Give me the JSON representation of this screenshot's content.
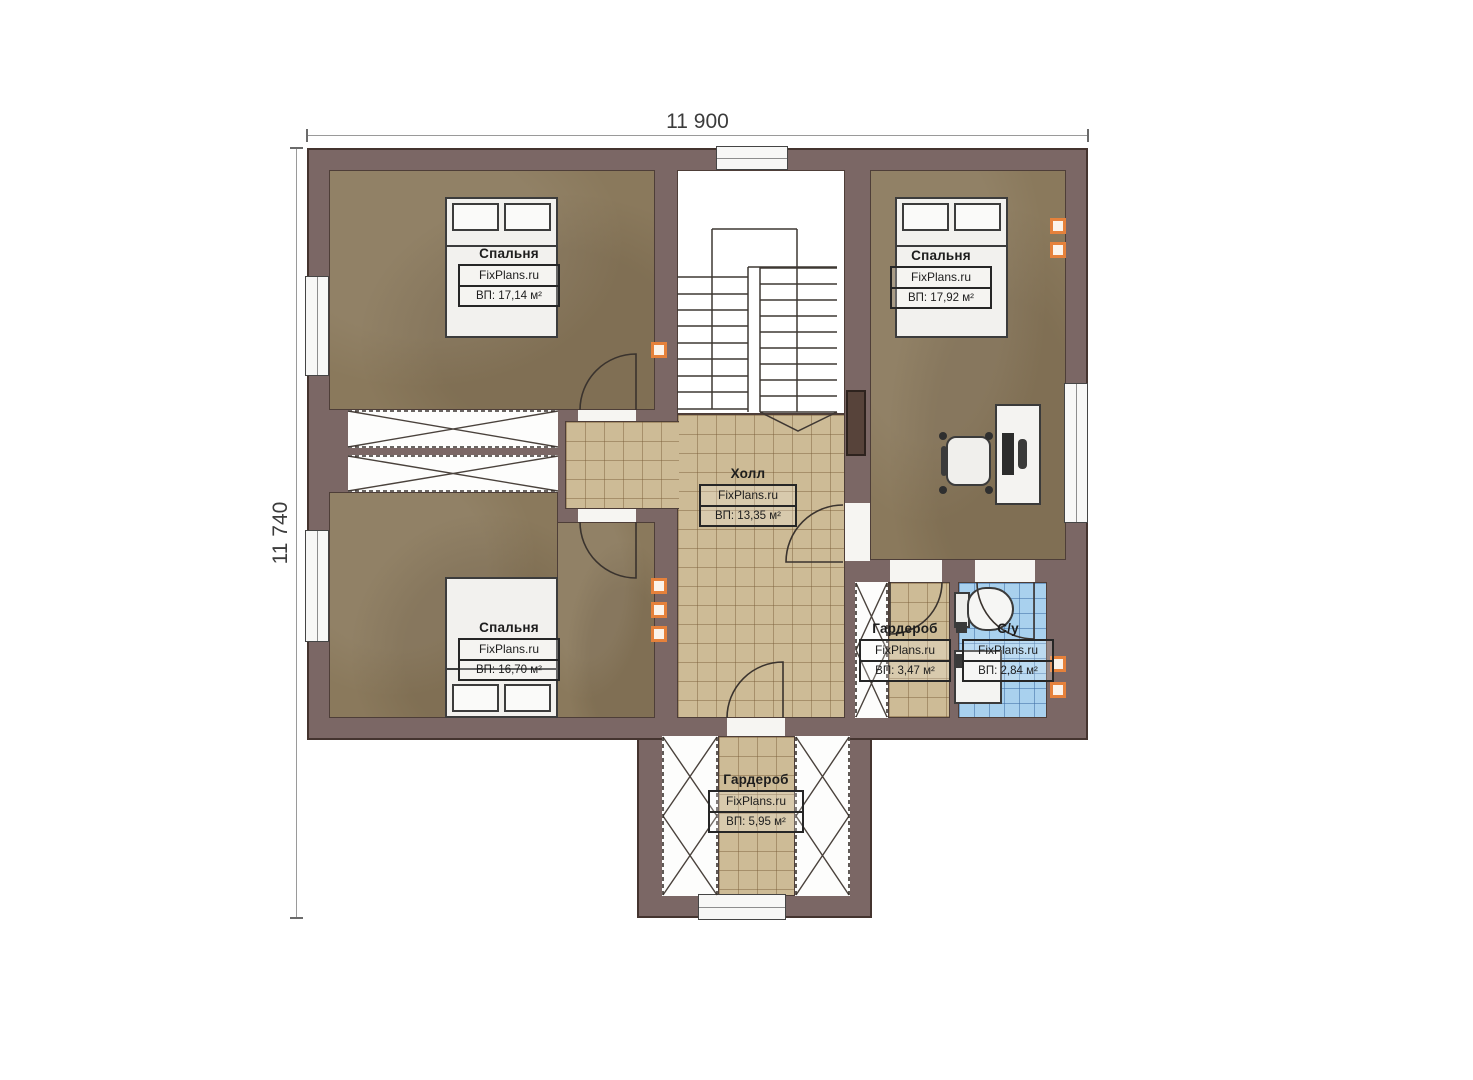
{
  "watermark": "FixPlans.ru",
  "dimensions": {
    "width_label": "11 900",
    "height_label": "11 740"
  },
  "rooms": [
    {
      "name": "Спальня",
      "brand": "FixPlans.ru",
      "area": "ВП: 17,14 м²"
    },
    {
      "name": "Спальня",
      "brand": "FixPlans.ru",
      "area": "ВП: 17,92 м²"
    },
    {
      "name": "Спальня",
      "brand": "FixPlans.ru",
      "area": "ВП: 16,70 м²"
    },
    {
      "name": "Холл",
      "brand": "FixPlans.ru",
      "area": "ВП: 13,35 м²"
    },
    {
      "name": "Гардероб",
      "brand": "FixPlans.ru",
      "area": "ВП: 3,47 м²"
    },
    {
      "name": "С/у",
      "brand": "FixPlans.ru",
      "area": "ВП: 2,84 м²"
    },
    {
      "name": "Гардероб",
      "brand": "FixPlans.ru",
      "area": "ВП: 5,95 м²"
    }
  ],
  "colors": {
    "wall": "#7b6765",
    "bedroom_floor": "#8a795c",
    "hall_tile": "#cdbb96",
    "bath_tile": "#a9d1ee",
    "vent_accent": "#e5813b"
  }
}
